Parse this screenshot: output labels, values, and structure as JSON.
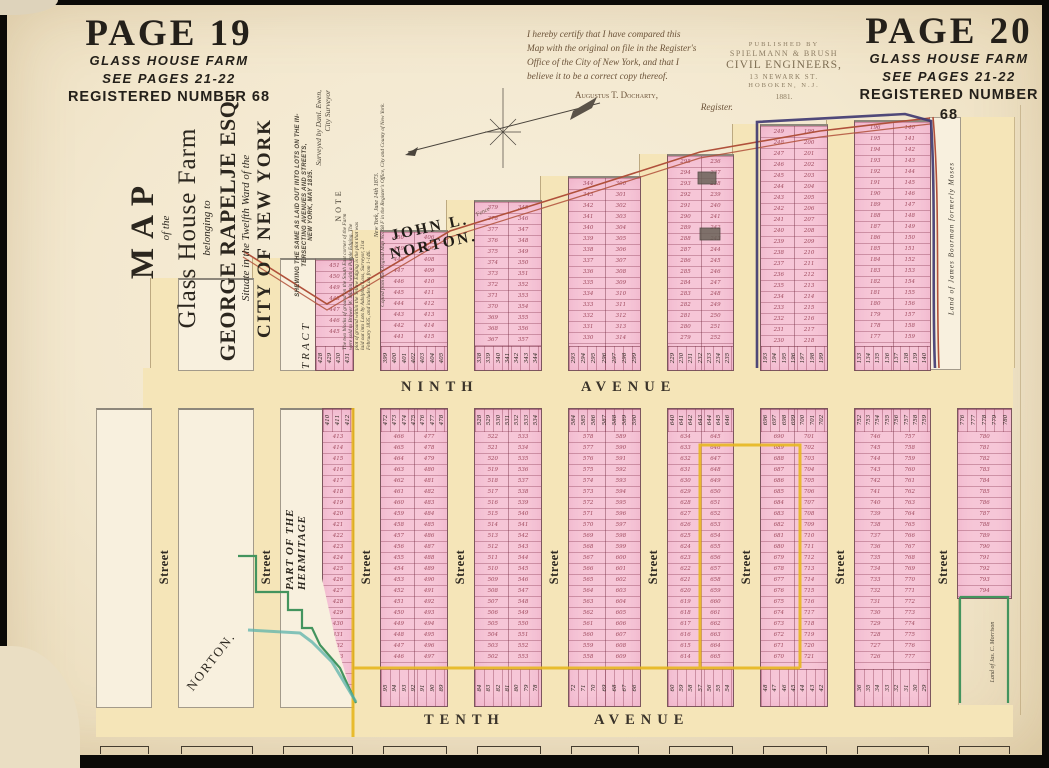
{
  "corners": {
    "p19": {
      "page": "PAGE 19",
      "farm": "GLASS HOUSE FARM",
      "see": "SEE PAGES 21-22",
      "reg": "REGISTERED NUMBER 68"
    },
    "p20": {
      "page": "PAGE 20",
      "farm": "GLASS HOUSE FARM",
      "see": "SEE PAGES 21-22",
      "reg": "REGISTERED NUMBER 68"
    }
  },
  "title": {
    "lines": [
      "MAP",
      "of the",
      "Glass House Farm",
      "belonging to",
      "GEORGE RAPELJE ESQ.",
      "Situate in the Twelfth Ward of the",
      "CITY OF NEW YORK"
    ]
  },
  "sub": {
    "lines": [
      "SHEWING THE SAME AS LAID OUT INTO LOTS ON THE IN-",
      "TERSECTING AVENUES AND STREETS,",
      "NEW YORK, MAY 1835."
    ],
    "surv1": "Surveyed by Danl. Ewen,",
    "surv2": "City Surveyor"
  },
  "note": {
    "head": "NOTE",
    "lines": [
      "The two blocks of ground on the South East corner of the Farm",
      "were sold to Brower W. Martin, with a Purple Edging. The",
      "plot of ground within the Yellow Edging is the plot that was",
      "laid out into Lots by Adolphus Loss, Surveyor, 21st",
      "February 1835, and includes Lots from 1-146."
    ],
    "date": "New York, June 14th 1873.",
    "copied": "Copied from the Original Map No. 68 F in the Register's Office, City and County of New York."
  },
  "cert": {
    "lines": [
      "I hereby certify that I have compared this",
      "Map with the original on file in the Register's",
      "Office of the City of New York, and that I",
      "believe it to be a correct copy thereof."
    ],
    "signer": "Augustus T. Docharty,",
    "role": "Register."
  },
  "pub": {
    "lines": [
      "PUBLISHED BY",
      "SPIELMANN & BRUSH",
      "CIVIL ENGINEERS,",
      "13 NEWARK ST.",
      "HOBOKEN, N.J.",
      "1881."
    ]
  },
  "labels": {
    "john": "JOHN L. NORTON.",
    "fence": "Fence",
    "ninth_a": "NINTH",
    "ninth_b": "AVENUE",
    "tenth_a": "TENTH",
    "tenth_b": "AVENUE",
    "street": "Street",
    "tract": "TRACT",
    "hermitage": "PART OF THE HERMITAGE",
    "norton": "NORTON.",
    "boorman": "Land of James Boorman formerly Moses",
    "morrison": "Land of Jas. C. Morrison"
  },
  "colors": {
    "paper": "#f3e8cf",
    "street_band": "#f5e5b8",
    "lot_pink": "#f6c6d7",
    "purple_edging": "#3d3670",
    "yellow_edging": "#e7b71f",
    "green_edging": "#43945e",
    "stream_teal": "#5cb3ab",
    "boundary_red": "#b0503a",
    "ink": "#2b261e"
  },
  "geom": {
    "band_w": 28,
    "streets": [
      150,
      252,
      352,
      446,
      540,
      639,
      732,
      826,
      929
    ],
    "street_tops": [
      278,
      258,
      230,
      200,
      176,
      154,
      124,
      120
    ],
    "ninth": {
      "x": 143,
      "y": 368,
      "w": 870,
      "h": 40
    },
    "tenth": {
      "x": 96,
      "y": 705,
      "w": 917,
      "h": 32
    },
    "top_blocks": [
      {
        "x": 178,
        "top": 278,
        "w": 74,
        "type": "white"
      },
      {
        "x": 280,
        "top": 258,
        "w": 35,
        "type": "white"
      },
      {
        "x": 315,
        "top": 258,
        "w": 37,
        "type": "pink",
        "cols": [
          {
            "s": 451,
            "d": -1
          }
        ],
        "strip": 428
      },
      {
        "x": 380,
        "top": 230,
        "w": 66,
        "type": "pink",
        "cols": [
          {
            "s": 450,
            "d": -1
          },
          {
            "s": 406,
            "d": 1
          }
        ],
        "strip": 399
      },
      {
        "x": 474,
        "top": 200,
        "w": 66,
        "type": "pink",
        "cols": [
          {
            "s": 379,
            "d": -1
          },
          {
            "s": 345,
            "d": 1
          }
        ],
        "strip": 338
      },
      {
        "x": 568,
        "top": 176,
        "w": 71,
        "type": "pink",
        "cols": [
          {
            "s": 344,
            "d": -1
          },
          {
            "s": 300,
            "d": 1
          }
        ],
        "strip": 293
      },
      {
        "x": 667,
        "top": 154,
        "w": 65,
        "type": "pink",
        "cols": [
          {
            "s": 295,
            "d": -1
          },
          {
            "s": 236,
            "d": 1
          }
        ],
        "strip": 229
      },
      {
        "x": 760,
        "top": 124,
        "w": 66,
        "type": "pink",
        "cols": [
          {
            "s": 249,
            "d": -1
          },
          {
            "s": 199,
            "d": 1
          }
        ],
        "strip": 193
      },
      {
        "x": 854,
        "top": 120,
        "w": 75,
        "type": "pink",
        "cols": [
          {
            "s": 196,
            "d": -1
          },
          {
            "s": 140,
            "d": 1
          }
        ],
        "strip": 133
      }
    ],
    "bottom_blocks": [
      {
        "x": 96,
        "w": 54,
        "type": "white"
      },
      {
        "x": 178,
        "w": 74,
        "type": "white"
      },
      {
        "x": 280,
        "w": 72,
        "type": "white"
      },
      {
        "x": 322,
        "w": 30,
        "type": "pink",
        "cols": [
          {
            "s": 413,
            "d": 1
          }
        ],
        "strip": 410,
        "clip": true,
        "bottom": 700
      },
      {
        "x": 380,
        "w": 66,
        "type": "pink",
        "cols": [
          {
            "s": 466,
            "d": -1
          },
          {
            "s": 477,
            "d": 1
          }
        ],
        "strip": 472,
        "strip2": 95
      },
      {
        "x": 474,
        "w": 66,
        "type": "pink",
        "cols": [
          {
            "s": 522,
            "d": -1
          },
          {
            "s": 533,
            "d": 1
          }
        ],
        "strip": 528,
        "strip2": 84
      },
      {
        "x": 568,
        "w": 71,
        "type": "pink",
        "cols": [
          {
            "s": 578,
            "d": -1
          },
          {
            "s": 589,
            "d": 1
          }
        ],
        "strip": 584,
        "strip2": 72
      },
      {
        "x": 667,
        "w": 65,
        "type": "pink",
        "cols": [
          {
            "s": 634,
            "d": -1
          },
          {
            "s": 645,
            "d": 1
          }
        ],
        "strip": 640,
        "strip2": 60
      },
      {
        "x": 760,
        "w": 66,
        "type": "pink",
        "cols": [
          {
            "s": 690,
            "d": -1
          },
          {
            "s": 701,
            "d": 1
          }
        ],
        "strip": 696,
        "strip2": 48
      },
      {
        "x": 854,
        "w": 75,
        "type": "pink",
        "cols": [
          {
            "s": 746,
            "d": -1
          },
          {
            "s": 757,
            "d": 1
          }
        ],
        "strip": 752,
        "strip2": 36
      },
      {
        "x": 957,
        "w": 53,
        "type": "pink",
        "cols": [
          {
            "s": 780,
            "d": 1
          }
        ],
        "strip": 776,
        "bottom": 597
      }
    ],
    "brackets": [
      [
        100,
        147
      ],
      [
        181,
        251
      ],
      [
        283,
        351
      ],
      [
        383,
        445
      ],
      [
        477,
        539
      ],
      [
        571,
        637
      ],
      [
        669,
        731
      ],
      [
        763,
        825
      ],
      [
        857,
        927
      ],
      [
        959,
        1008
      ]
    ]
  }
}
